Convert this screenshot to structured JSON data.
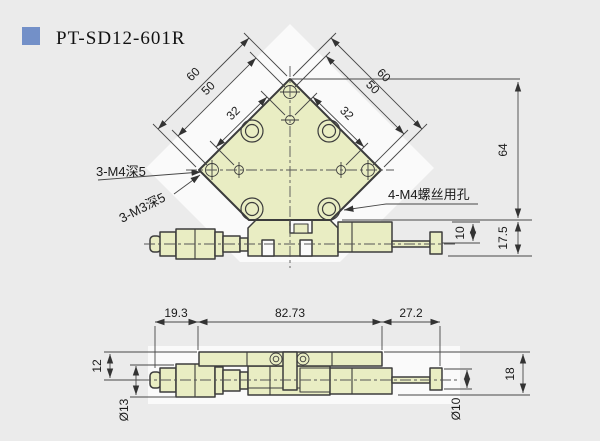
{
  "title": {
    "label": "PT-SD12-601R",
    "icon_color": "#7390c8"
  },
  "colors": {
    "background": "#ebebeb",
    "backdrop": "#fafafa",
    "part_fill": "#e9edc3",
    "outline": "#3c3c3c",
    "dim_line": "#474747",
    "text": "#1a1a1a",
    "accent_square": "#7390c8"
  },
  "top_view": {
    "dim_left_60": "60",
    "dim_left_50": "50",
    "dim_left_32": "32",
    "dim_right_60": "60",
    "dim_right_50": "50",
    "dim_right_32": "32",
    "dim_height": "64",
    "dim_rod": "10",
    "dim_base_height": "17.5",
    "label_m4_holes": "3-M4深5",
    "label_m3_holes": "3-M3深5",
    "label_screw_holes": "4-M4螺丝用孔"
  },
  "side_view": {
    "dim_left": "19.3",
    "dim_body": "82.73",
    "dim_right": "27.2",
    "dim_axis_height": "12",
    "dim_knob_dia": "Ø13",
    "dim_rod_dia": "Ø10",
    "dim_total_height": "18"
  }
}
